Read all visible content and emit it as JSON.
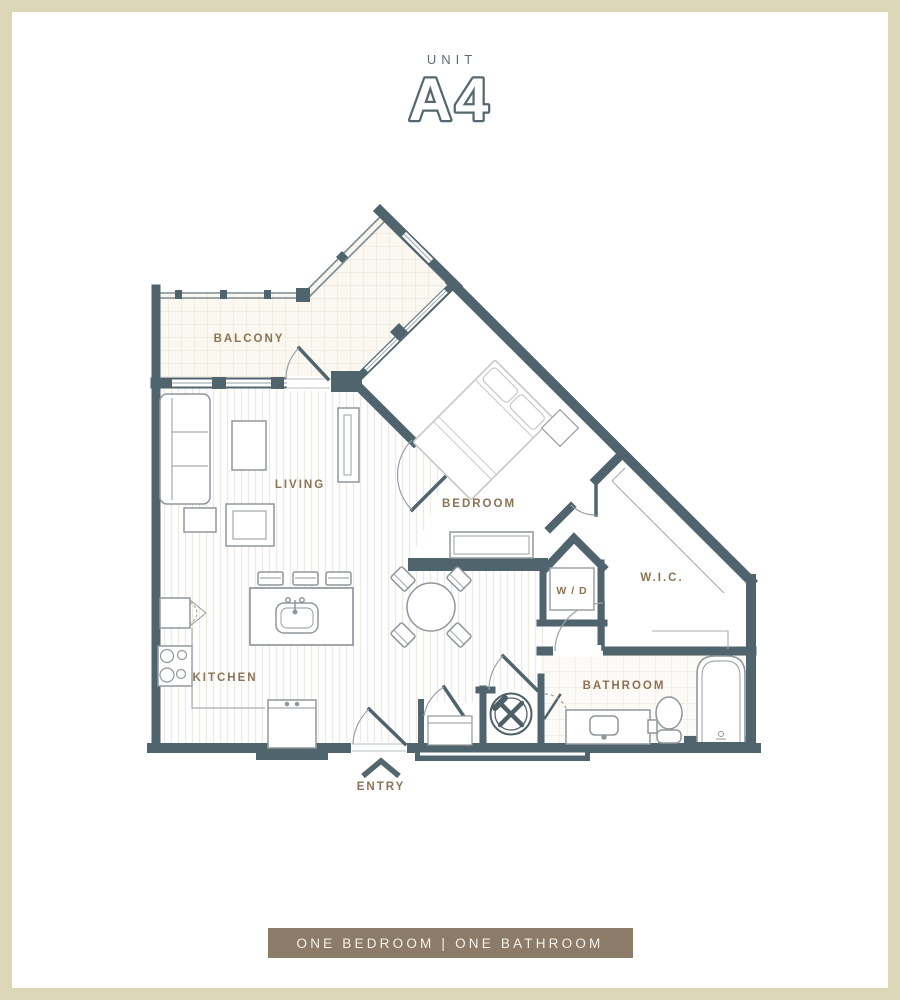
{
  "page": {
    "frame_color": "#dcd7b7",
    "background": "#ffffff"
  },
  "header": {
    "eyebrow": "UNIT",
    "unit_name": "A4",
    "text_color": "#5d6c73",
    "unit_color": "#55686f"
  },
  "floor_plan": {
    "wall_color": "#50646d",
    "label_color": "#8d7355",
    "rooms": {
      "balcony": "BALCONY",
      "living": "LIVING",
      "bedroom": "BEDROOM",
      "kitchen": "KITCHEN",
      "washer_dryer": "W / D",
      "walk_in_closet": "W.I.C.",
      "bathroom": "BATHROOM",
      "entry": "ENTRY"
    }
  },
  "footer": {
    "banner_label": "ONE BEDROOM | ONE BATHROOM",
    "banner_color": "#8b7b68",
    "banner_text_color": "#f5f1e8"
  }
}
